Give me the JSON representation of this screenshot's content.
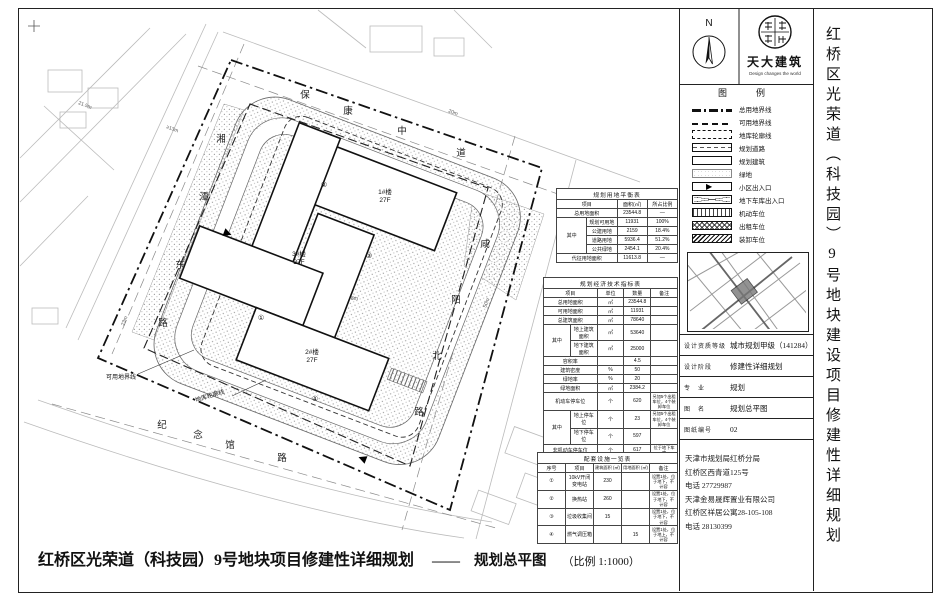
{
  "sheet": {
    "side_title": "红桥区光荣道（科技园）9号地块建设项目修建性详细规划",
    "bottom_title": "红桥区光荣道（科技园）9号地块项目修建性详细规划",
    "bottom_dash": "——",
    "bottom_drawing_name": "规划总平图",
    "bottom_scale": "（比例 1:1000）"
  },
  "header": {
    "north_label": "N",
    "firm_name": "天大建筑",
    "firm_tagline": "Design changes the world"
  },
  "legend": {
    "title": "图　例",
    "items": [
      {
        "label": "总用地界线",
        "swatch": "sw-site-boundary"
      },
      {
        "label": "可用地界线",
        "swatch": "sw-usable-boundary"
      },
      {
        "label": "地库轮廓线",
        "swatch": "sw-basement"
      },
      {
        "label": "规划道路",
        "swatch": "sw-road"
      },
      {
        "label": "规划建筑",
        "swatch": "sw-building"
      },
      {
        "label": "绿地",
        "swatch": "sw-green"
      },
      {
        "label": "小区出入口",
        "swatch": "sw-entrance"
      },
      {
        "label": "地下车库出入口",
        "swatch": "sw-garage"
      },
      {
        "label": "机动车位",
        "swatch": "sw-parking-motor"
      },
      {
        "label": "出租车位",
        "swatch": "sw-parking-taxi"
      },
      {
        "label": "装卸车位",
        "swatch": "sw-parking-loading"
      }
    ]
  },
  "titleblock": {
    "rows": [
      {
        "label": "设计资质等级",
        "value": "城市规划甲级（141284）"
      },
      {
        "label": "设计阶段",
        "value": "修建性详细规划"
      },
      {
        "label": "专　业",
        "value": "规划"
      },
      {
        "label": "图　名",
        "value": "规划总平图"
      },
      {
        "label": "图纸编号",
        "value": "02"
      }
    ]
  },
  "contacts": {
    "lines": [
      "天津市规划局红桥分局",
      "红桥区西青道125号",
      "电话 27729987",
      "天津金易晟辉置业有限公司",
      "红桥区祥居公寓28-105-108",
      "电话 28130399"
    ]
  },
  "tables": {
    "balance": {
      "title": "规划用地平衡表",
      "h": [
        "项目",
        "面积(㎡)",
        "所占比例"
      ],
      "zl": "其中",
      "r1": [
        "总用地面积",
        "23544.8",
        "—"
      ],
      "r2": [
        "规划可用地",
        "11931",
        "100%"
      ],
      "r3": [
        "公建用地",
        "2159",
        "18.4%"
      ],
      "r4": [
        "道路用地",
        "5936.4",
        "51.2%"
      ],
      "r5": [
        "公共绿地",
        "2454.1",
        "20.4%"
      ],
      "r6": [
        "代征用地面积",
        "11613.8",
        "—"
      ]
    },
    "tech": {
      "title": "规划经济技术指标表",
      "h": [
        "项目",
        "单位",
        "数量",
        "备注"
      ],
      "zl1": "其中",
      "zl2": "其中",
      "r1": [
        "总用地面积",
        "㎡",
        "23544.8",
        ""
      ],
      "r2": [
        "可用地面积",
        "㎡",
        "11931",
        ""
      ],
      "r3": [
        "总建筑面积",
        "㎡",
        "78640",
        ""
      ],
      "r4": [
        "地上建筑面积",
        "㎡",
        "53640",
        ""
      ],
      "r5": [
        "地下建筑面积",
        "㎡",
        "25000",
        ""
      ],
      "r6": [
        "容积率",
        "",
        "4.5",
        ""
      ],
      "r7": [
        "建筑密度",
        "%",
        "50",
        ""
      ],
      "r8": [
        "绿地率",
        "%",
        "20",
        ""
      ],
      "r9": [
        "绿地面积",
        "㎡",
        "2384.2",
        ""
      ],
      "r10": [
        "机动车停车位",
        "个",
        "620",
        "另加5个出租车位，4个装卸车位"
      ],
      "r11": [
        "地上停车位",
        "个",
        "23",
        "另加5个出租车位，4个装卸车位"
      ],
      "r12": [
        "地下停车位",
        "个",
        "597",
        ""
      ],
      "r13": [
        "非机动车停车位",
        "个",
        "617",
        "位于地下车库"
      ]
    },
    "facilities": {
      "title": "配套设施一览表",
      "h": [
        "序号",
        "项目",
        "建筑面积 (㎡)",
        "用地面积 (㎡)",
        "备注"
      ],
      "r1": [
        "①",
        "10kV开闭变电站",
        "230",
        "",
        "设置1处，位于地下，不计容"
      ],
      "r2": [
        "②",
        "换热站",
        "260",
        "",
        "设置1处，位于地下，不计容"
      ],
      "r3": [
        "③",
        "垃圾收集间",
        "15",
        "",
        "设置1处，位于地下，不计容"
      ],
      "r4": [
        "④",
        "燃气调压箱",
        "",
        "15",
        "设置1处，位于地上，不计容"
      ]
    }
  },
  "plan": {
    "roads": {
      "top": {
        "name": "保康中道",
        "chars": [
          "保",
          "康",
          "中",
          "道"
        ]
      },
      "right": {
        "name": "咸阳北路",
        "chars": [
          "咸",
          "阳",
          "北",
          "路"
        ]
      },
      "left": {
        "name": "湘潭东路",
        "chars": [
          "湘",
          "潭",
          "东",
          "路"
        ]
      },
      "bottom": {
        "name": "纪念馆路",
        "chars": [
          "纪",
          "念",
          "馆",
          "路"
        ]
      }
    },
    "buildings": [
      {
        "name": "1#楼",
        "floors": "27F"
      },
      {
        "name": "3#楼",
        "floors": "27F"
      },
      {
        "name": "2#楼",
        "floors": "27F"
      }
    ],
    "annotations": {
      "usable": "可用地界线",
      "basement": "地库轮廓线"
    },
    "marks": [
      "①",
      "②",
      "③",
      "④"
    ],
    "dims": [
      "21.5m",
      "≥13m",
      "23m",
      "8m",
      "50m",
      "20m"
    ]
  }
}
